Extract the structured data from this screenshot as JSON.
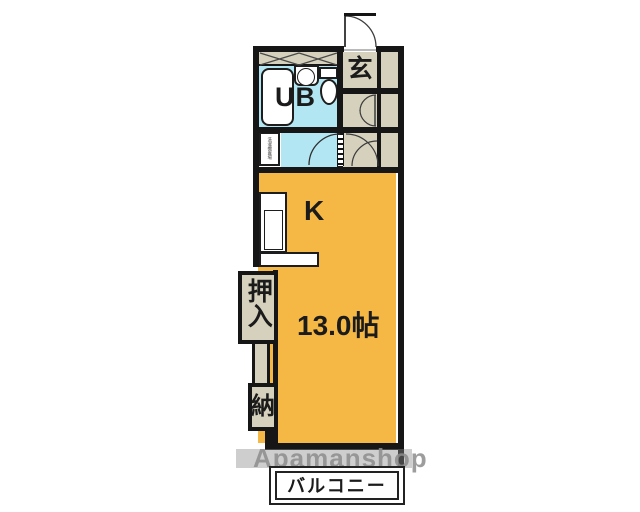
{
  "floorplan": {
    "rooms": {
      "entrance": "玄",
      "unit_bath": "UB",
      "kitchen": "K",
      "living_size": "13.0帖",
      "closet": "押入",
      "storage": "納",
      "washing_machine": "洗濯機置場",
      "balcony": "バルコニー"
    },
    "watermark": "Apamanshop",
    "colors": {
      "room_fill": "#f6b845",
      "bath_fill": "#b3e6f3",
      "service_fill": "#d5d1bd",
      "wall": "#161616",
      "watermark_text": "#8d8d8d"
    }
  }
}
